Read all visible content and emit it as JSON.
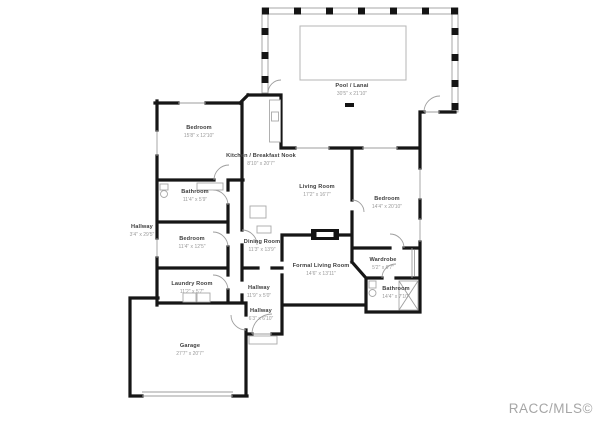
{
  "watermark": "RACC/MLS©",
  "colors": {
    "background": "#ffffff",
    "wall": "#161616",
    "thin_line": "#9e9e9e",
    "room_name": "#3d3d3d",
    "room_dims": "#9a9a9a",
    "watermark": "#a6a6a6"
  },
  "rooms": {
    "pool_lanai": {
      "name": "Pool / Lanai",
      "dims": "30'5\" x 21'10\""
    },
    "bedroom_1": {
      "name": "Bedroom",
      "dims": "15'8\" x 12'10\""
    },
    "kitchen": {
      "name": "Kitchen / Breakfast Nook",
      "dims": "8'10\" x 20'7\""
    },
    "living_room": {
      "name": "Living Room",
      "dims": "17'2\" x 16'7\""
    },
    "bedroom_2": {
      "name": "Bedroom",
      "dims": "14'4\" x 20'10\""
    },
    "bathroom_1": {
      "name": "Bathroom",
      "dims": "11'4\" x 5'9\""
    },
    "hallway_1": {
      "name": "Hallway",
      "dims": "3'4\" x 29'5\""
    },
    "bedroom_3": {
      "name": "Bedroom",
      "dims": "11'4\" x 12'5\""
    },
    "dining_room": {
      "name": "Dining Room",
      "dims": "11'3\" x 13'9\""
    },
    "formal_living": {
      "name": "Formal Living  Room",
      "dims": "14'6\" x 13'11\""
    },
    "wardrobe": {
      "name": "Wardrobe",
      "dims": "5'2\" x 6'7\""
    },
    "bathroom_2": {
      "name": "Bathroom",
      "dims": "14'4\" x 7'10\""
    },
    "laundry": {
      "name": "Laundry Room",
      "dims": "11'2\" x 5'7\""
    },
    "hallway_2": {
      "name": "Hallway",
      "dims": "11'9\" x 5'0\""
    },
    "hallway_3": {
      "name": "Hallway",
      "dims": "6'3\" x 6'10\""
    },
    "garage": {
      "name": "Garage",
      "dims": "27'7\" x 20'7\""
    }
  }
}
